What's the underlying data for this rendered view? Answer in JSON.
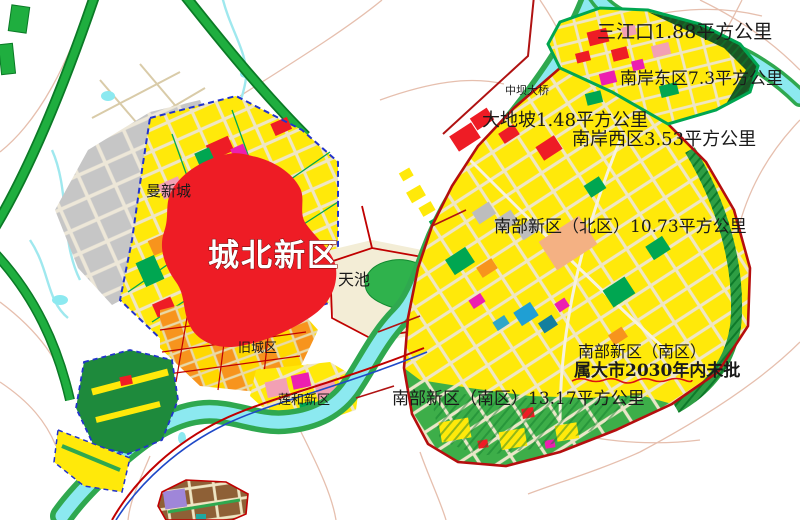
{
  "map": {
    "labels": {
      "sanjiangkou": "三江口1.88平方公里",
      "nanan_east": "南岸东区7.3平方公里",
      "zhongba_bridge": "中坝大桥",
      "dadipo": "大地坡1.48平方公里",
      "nanan_west": "南岸西区3.53平方公里",
      "nanbu_north": "南部新区（北区）10.73平方公里",
      "nanbu_south": "南部新区（南区）13.17平方公里",
      "note_line1": "南部新区（南区）",
      "note_line2": "属大市2030年内未批",
      "chengbei": "城北新区",
      "tianchi": "天池",
      "manxincheng": "曼新城",
      "old_town": "旧城区",
      "lianhe": "莲和新区"
    },
    "districts": [
      {
        "name": "三江口",
        "area": "1.88平方公里"
      },
      {
        "name": "南岸东区",
        "area": "7.3平方公里"
      },
      {
        "name": "大地坡",
        "area": "1.48平方公里"
      },
      {
        "name": "南岸西区",
        "area": "3.53平方公里"
      },
      {
        "name": "南部新区（北区）",
        "area": "10.73平方公里"
      },
      {
        "name": "南部新区（南区）",
        "area": "13.17平方公里",
        "note": "属大市2030年内未批"
      },
      {
        "name": "城北新区"
      },
      {
        "name": "旧城区"
      },
      {
        "name": "莲和新区"
      },
      {
        "name": "曼新城"
      },
      {
        "name": "天池"
      },
      {
        "name": "中坝大桥"
      }
    ],
    "colors": {
      "residential_yellow": "#FFE90A",
      "park_green": "#2FA84F",
      "expressway_green": "#1FAE3F",
      "water_cyan": "#8CE9F0",
      "highlight_red": "#EE1C25",
      "boundary_red": "#B50E0E",
      "boundary_blue": "#2233CC",
      "existing_gray": "#C6C6C6",
      "old_town_orange": "#F7941D",
      "note_underline_red": "#DD1111"
    }
  }
}
